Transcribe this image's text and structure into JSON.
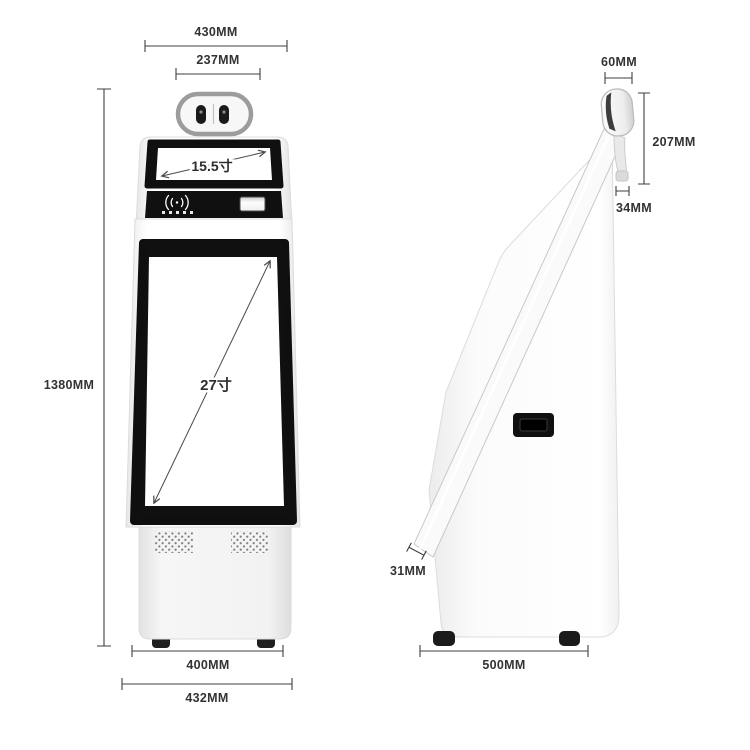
{
  "diagram": {
    "type": "product-dimension-diagram",
    "product": "floor-standing self-service kiosk, front and side elevation with measurements"
  },
  "front_view": {
    "dims": {
      "top_width": "430MM",
      "camera_width": "237MM",
      "height": "1380MM",
      "feet_width": "400MM",
      "base_width": "432MM"
    },
    "screens": {
      "top_screen_size": "15.5寸",
      "main_screen_size": "27寸"
    }
  },
  "side_view": {
    "dims": {
      "head_depth": "60MM",
      "head_screen_height": "207MM",
      "screen_top_thickness": "34MM",
      "screen_bottom_thickness": "31MM",
      "base_depth": "500MM"
    }
  },
  "icons": {
    "nfc": "contactless-payment-icon",
    "camera": "dual-camera-module",
    "slot": "receipt-card-slot"
  },
  "colors": {
    "background": "#ffffff",
    "panel_black": "#101010",
    "dim_line": "#3f3f3f",
    "text": "#333333",
    "camera_ring_gray": "#9c9c9c",
    "body_edge": "#dcdcdc",
    "foot_black": "#1f1f1f"
  }
}
